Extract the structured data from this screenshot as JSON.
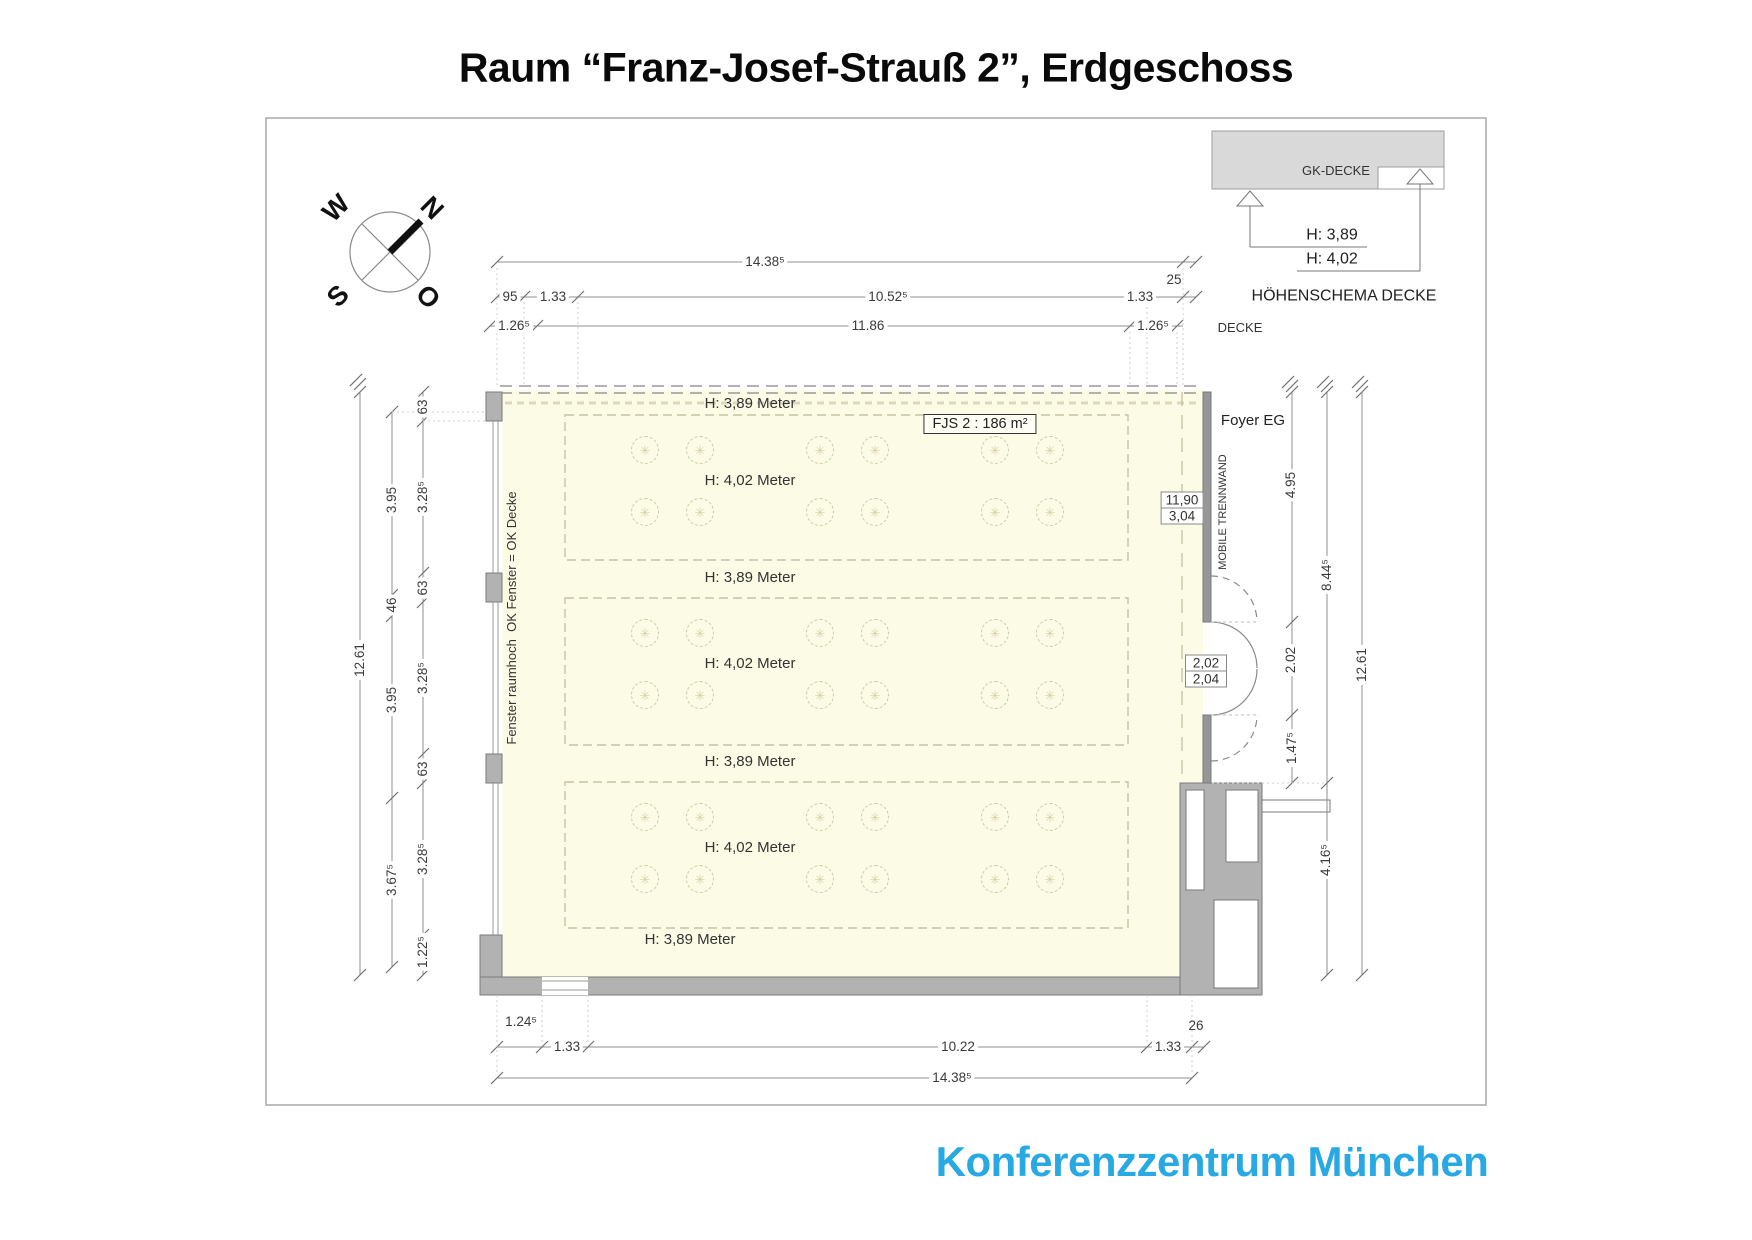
{
  "page": {
    "title": "Raum “Franz-Josef-Strauß 2”, Erdgeschoss",
    "logo": "Konferenzzentrum München",
    "logo_color": "#29a9e3",
    "room_fill_color": "#fcfbe6",
    "wall_color": "#b2b2b2"
  },
  "room_label": "FJS  2 : 186 m²",
  "partition_box": {
    "top": "11,90",
    "bottom": "3,04"
  },
  "door_box": {
    "top": "2,02",
    "bottom": "2,04"
  },
  "labels": [
    {
      "n": "compass-letter-w",
      "t": "W",
      "x": 336,
      "y": 208,
      "r": -45,
      "s": 27,
      "w": "bold",
      "c": "#111"
    },
    {
      "n": "compass-letter-n",
      "t": "N",
      "x": 432,
      "y": 208,
      "r": 45,
      "s": 27,
      "w": "bold",
      "c": "#111"
    },
    {
      "n": "compass-letter-s",
      "t": "S",
      "x": 338,
      "y": 296,
      "r": -45,
      "s": 27,
      "w": "bold",
      "c": "#111"
    },
    {
      "n": "compass-letter-o",
      "t": "O",
      "x": 428,
      "y": 297,
      "r": 45,
      "s": 27,
      "w": "bold",
      "c": "#111"
    },
    {
      "n": "label-gk-decke",
      "t": "GK-DECKE",
      "x": 1336,
      "y": 171,
      "s": 13,
      "c": "#333"
    },
    {
      "n": "dim-height-389",
      "t": "H: 3,89",
      "x": 1332,
      "y": 236,
      "s": 16,
      "c": "#222"
    },
    {
      "n": "dim-height-402",
      "t": "H: 4,02",
      "x": 1332,
      "y": 260,
      "s": 16,
      "c": "#222"
    },
    {
      "n": "label-hoehenschema-decke",
      "t": "HÖHENSCHEMA DECKE",
      "x": 1344,
      "y": 297,
      "s": 16,
      "c": "#222"
    },
    {
      "n": "label-decke",
      "t": "DECKE",
      "x": 1240,
      "y": 328,
      "s": 13,
      "c": "#333"
    },
    {
      "n": "dim-top-total",
      "t": "14.38⁵",
      "x": 765,
      "y": 262,
      "bg": 1
    },
    {
      "n": "dim-top-25",
      "t": "25",
      "x": 1174,
      "y": 280
    },
    {
      "n": "dim-top-95",
      "t": "95",
      "x": 510,
      "y": 297,
      "bg": 1
    },
    {
      "n": "dim-top-133-left",
      "t": "1.33",
      "x": 553,
      "y": 297,
      "bg": 1
    },
    {
      "n": "dim-top-1052",
      "t": "10.52⁵",
      "x": 888,
      "y": 297,
      "bg": 1
    },
    {
      "n": "dim-top-133-right",
      "t": "1.33",
      "x": 1140,
      "y": 297,
      "bg": 1
    },
    {
      "n": "dim-top-126-left",
      "t": "1.26⁵",
      "x": 514,
      "y": 326,
      "bg": 1
    },
    {
      "n": "dim-top-1186",
      "t": "11.86",
      "x": 868,
      "y": 326,
      "bg": 1
    },
    {
      "n": "dim-top-126-right",
      "t": "1.26⁵",
      "x": 1153,
      "y": 326,
      "bg": 1
    },
    {
      "n": "dim-left-1261",
      "t": "12.61",
      "x": 360,
      "y": 660,
      "r": -90,
      "bg": 1
    },
    {
      "n": "dim-left-395-upper",
      "t": "3.95",
      "x": 392,
      "y": 500,
      "r": -90,
      "bg": 1
    },
    {
      "n": "dim-left-46",
      "t": "46",
      "x": 392,
      "y": 605,
      "r": -90,
      "bg": 1
    },
    {
      "n": "dim-left-395-lower",
      "t": "3.95",
      "x": 392,
      "y": 700,
      "r": -90,
      "bg": 1
    },
    {
      "n": "dim-left-367",
      "t": "3.67⁵",
      "x": 392,
      "y": 880,
      "r": -90,
      "bg": 1
    },
    {
      "n": "dim-left-63-a",
      "t": "63",
      "x": 423,
      "y": 407,
      "r": -90,
      "bg": 1
    },
    {
      "n": "dim-left-328-a",
      "t": "3.28⁵",
      "x": 423,
      "y": 497,
      "r": -90,
      "bg": 1
    },
    {
      "n": "dim-left-63-b",
      "t": "63",
      "x": 423,
      "y": 588,
      "r": -90,
      "bg": 1
    },
    {
      "n": "dim-left-328-b",
      "t": "3.28⁵",
      "x": 423,
      "y": 678,
      "r": -90,
      "bg": 1
    },
    {
      "n": "dim-left-63-c",
      "t": "63",
      "x": 423,
      "y": 769,
      "r": -90,
      "bg": 1
    },
    {
      "n": "dim-left-328-c",
      "t": "3.28⁵",
      "x": 423,
      "y": 859,
      "r": -90,
      "bg": 1
    },
    {
      "n": "dim-left-122",
      "t": "1.22⁵",
      "x": 423,
      "y": 952,
      "r": -90,
      "bg": 1
    },
    {
      "n": "label-fenster-raumhoch",
      "t": "Fenster raumhoch  OK Fenster = OK Decke",
      "x": 512,
      "y": 618,
      "r": -90,
      "s": 13,
      "c": "#333"
    },
    {
      "n": "label-h389-1",
      "t": "H: 3,89 Meter",
      "x": 750,
      "y": 404,
      "s": 15,
      "c": "#333"
    },
    {
      "n": "label-h402-1",
      "t": "H: 4,02 Meter",
      "x": 750,
      "y": 481,
      "s": 15,
      "c": "#333"
    },
    {
      "n": "label-h389-2",
      "t": "H: 3,89 Meter",
      "x": 750,
      "y": 578,
      "s": 15,
      "c": "#333"
    },
    {
      "n": "label-h402-2",
      "t": "H: 4,02 Meter",
      "x": 750,
      "y": 664,
      "s": 15,
      "c": "#333"
    },
    {
      "n": "label-h389-3",
      "t": "H: 3,89 Meter",
      "x": 750,
      "y": 762,
      "s": 15,
      "c": "#333"
    },
    {
      "n": "label-h402-3",
      "t": "H: 4,02 Meter",
      "x": 750,
      "y": 848,
      "s": 15,
      "c": "#333"
    },
    {
      "n": "label-h389-4",
      "t": "H: 3,89 Meter",
      "x": 690,
      "y": 940,
      "s": 15,
      "c": "#333"
    },
    {
      "n": "label-foyer-eg",
      "t": "Foyer EG",
      "x": 1253,
      "y": 421,
      "s": 15,
      "c": "#222"
    },
    {
      "n": "label-mobile-trennwand",
      "t": "MOBILE TRENNWAND",
      "x": 1224,
      "y": 512,
      "r": -90,
      "s": 11,
      "c": "#333"
    },
    {
      "n": "dim-right-495",
      "t": "4.95",
      "x": 1291,
      "y": 485,
      "r": -90,
      "bg": 1
    },
    {
      "n": "dim-right-202",
      "t": "2.02",
      "x": 1291,
      "y": 660,
      "r": -90,
      "bg": 1
    },
    {
      "n": "dim-right-147",
      "t": "1.47⁵",
      "x": 1292,
      "y": 748,
      "r": -90,
      "bg": 1
    },
    {
      "n": "dim-right-844",
      "t": "8.44⁵",
      "x": 1327,
      "y": 575,
      "r": -90,
      "bg": 1
    },
    {
      "n": "dim-right-416",
      "t": "4.16⁵",
      "x": 1326,
      "y": 860,
      "r": -90,
      "bg": 1
    },
    {
      "n": "dim-right-1261",
      "t": "12.61",
      "x": 1362,
      "y": 665,
      "r": -90,
      "bg": 1
    },
    {
      "n": "dim-bottom-124",
      "t": "1.24⁵",
      "x": 521,
      "y": 1022
    },
    {
      "n": "dim-bottom-133-left",
      "t": "1.33",
      "x": 567,
      "y": 1047,
      "bg": 1
    },
    {
      "n": "dim-bottom-1022",
      "t": "10.22",
      "x": 958,
      "y": 1047,
      "bg": 1
    },
    {
      "n": "dim-bottom-133-right",
      "t": "1.33",
      "x": 1168,
      "y": 1047,
      "bg": 1
    },
    {
      "n": "dim-bottom-26",
      "t": "26",
      "x": 1196,
      "y": 1026
    },
    {
      "n": "dim-bottom-total",
      "t": "14.38⁵",
      "x": 952,
      "y": 1078,
      "bg": 1
    }
  ],
  "lights": {
    "glyph": "✳",
    "cols": [
      645,
      700,
      820,
      875,
      995,
      1050
    ],
    "rows": [
      450,
      512,
      633,
      695,
      817,
      879
    ]
  }
}
